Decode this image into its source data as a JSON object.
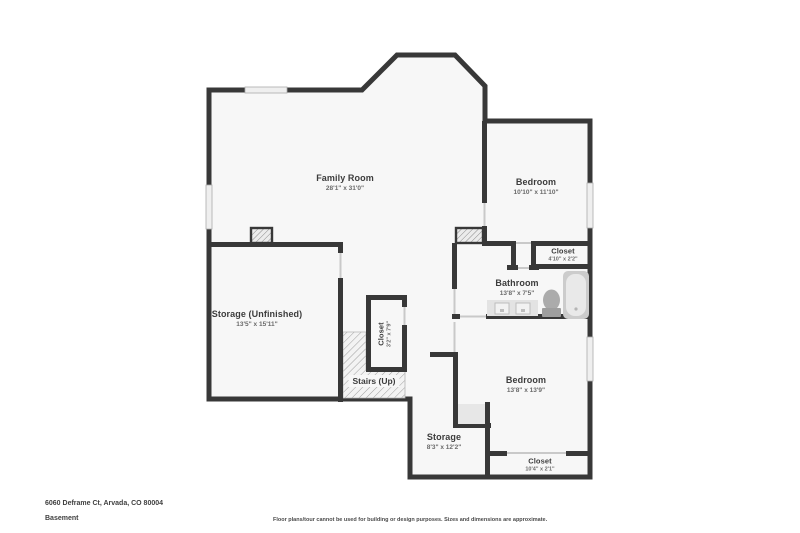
{
  "plan": {
    "rooms": [
      {
        "id": "family-room",
        "name": "Family Room",
        "dims": "28'1\" x 31'0\""
      },
      {
        "id": "bedroom-1",
        "name": "Bedroom",
        "dims": "10'10\" x 11'10\""
      },
      {
        "id": "closet-1",
        "name": "Closet",
        "dims": "4'10\" x 2'2\""
      },
      {
        "id": "bathroom",
        "name": "Bathroom",
        "dims": "13'8\" x 7'5\""
      },
      {
        "id": "storage-unfinished",
        "name": "Storage (Unfinished)",
        "dims": "13'5\" x 15'11\""
      },
      {
        "id": "closet-2",
        "name": "Closet",
        "dims": "3'2\" x 7'9\""
      },
      {
        "id": "stairs",
        "name": "Stairs (Up)",
        "dims": ""
      },
      {
        "id": "bedroom-2",
        "name": "Bedroom",
        "dims": "13'8\" x 13'9\""
      },
      {
        "id": "storage-2",
        "name": "Storage",
        "dims": "8'3\" x 12'2\""
      },
      {
        "id": "closet-3",
        "name": "Closet",
        "dims": "10'4\" x 2'1\""
      }
    ],
    "fixtures": [
      "bathtub",
      "toilet",
      "vanity-sinks"
    ],
    "colors": {
      "wall": "#383838",
      "floor": "#f7f7f7",
      "window": "#efefef",
      "opening": "#c9c9c9",
      "hatch_line": "#9f9f9f",
      "fixture": "#d6d6d6"
    }
  },
  "footer": {
    "address": "6060 Deframe Ct, Arvada, CO 80004",
    "level": "Basement",
    "disclaimer": "Floor plans/tour cannot be used for building or design purposes. Sizes and dimensions are approximate."
  }
}
